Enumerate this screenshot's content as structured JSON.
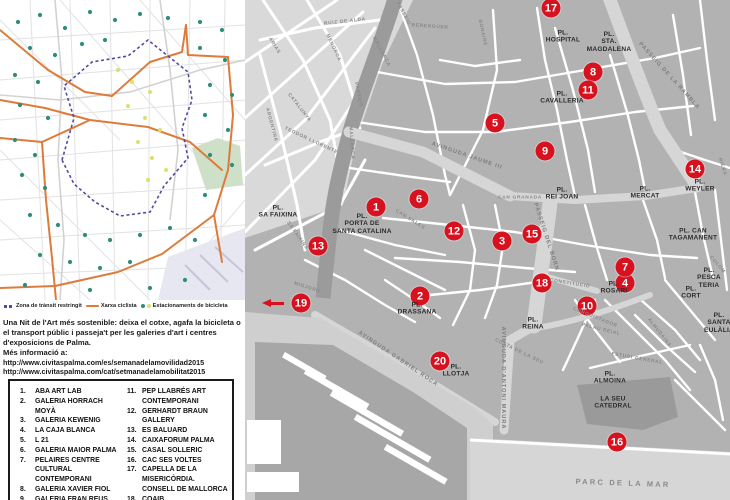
{
  "left_panel": {
    "legend": [
      {
        "label": "Zona de trànsit restringit",
        "color": "#4d4da0"
      },
      {
        "label": "Xarxa ciclista",
        "color": "#dd7b3a"
      },
      {
        "label": "Estacionaments de bicicleta",
        "colors": [
          "#2f8d7e",
          "#dde06a"
        ]
      }
    ],
    "intro": "Una Nit de l'Art més sostenible: deixa el cotxe, agafa la bicicleta o el transport públic i passeja't per les galeries d'art i centres d'exposicions de Palma.",
    "more_info_label": "Més informació a:",
    "links": [
      "http://www.civitaspalma.com/es/semanadelamovilidad2015",
      "http://www.civitaspalma.com/cat/setmanadelamobilitat2015"
    ],
    "gallery_list": {
      "left": [
        {
          "num": "1.",
          "name": "ABA ART LAB"
        },
        {
          "num": "2.",
          "name": "GALERIA HORRACH MOYÀ"
        },
        {
          "num": "3.",
          "name": "GALERIA KEWENIG"
        },
        {
          "num": "4.",
          "name": "LA CAJA BLANCA"
        },
        {
          "num": "5.",
          "name": "L 21"
        },
        {
          "num": "6.",
          "name": "GALERIA MAIOR PALMA"
        },
        {
          "num": "7.",
          "name": "PELAIRES CENTRE CULTURAL CONTEMPORANI"
        },
        {
          "num": "8.",
          "name": "GALERIA XAVIER FIOL"
        },
        {
          "num": "9.",
          "name": "GALERIA FRAN REUS"
        },
        {
          "num": "10.",
          "name": "GABRIEL VANRELL-GALERIA"
        }
      ],
      "right": [
        {
          "num": "11.",
          "name": "PEP LLABRÉS ART CONTEMPORANI"
        },
        {
          "num": "12.",
          "name": "GERHARDT BRAUN GALLERY"
        },
        {
          "num": "13.",
          "name": "ES BALUARD"
        },
        {
          "num": "14.",
          "name": "CAIXAFORUM PALMA"
        },
        {
          "num": "15.",
          "name": "CASAL SOLLERIC"
        },
        {
          "num": "16.",
          "name": "CAC SES VOLTES"
        },
        {
          "num": "17.",
          "name": "CAPELLA DE LA MISERICÒRDIA. CONSELL DE MALLORCA"
        },
        {
          "num": "18.",
          "name": "COAIB"
        },
        {
          "num": "19.",
          "name": "FUNDACIÓ PILAR I JOAN MIRÓ A MALLORCA"
        }
      ]
    }
  },
  "map": {
    "marker_color": "#d8111f",
    "markers": [
      {
        "num": "1",
        "x": 131,
        "y": 207
      },
      {
        "num": "2",
        "x": 175,
        "y": 296
      },
      {
        "num": "3",
        "x": 257,
        "y": 241
      },
      {
        "num": "4",
        "x": 380,
        "y": 283
      },
      {
        "num": "5",
        "x": 250,
        "y": 123
      },
      {
        "num": "6",
        "x": 174,
        "y": 199
      },
      {
        "num": "7",
        "x": 380,
        "y": 267
      },
      {
        "num": "8",
        "x": 348,
        "y": 72
      },
      {
        "num": "9",
        "x": 300,
        "y": 151
      },
      {
        "num": "10",
        "x": 342,
        "y": 306
      },
      {
        "num": "11",
        "x": 343,
        "y": 90
      },
      {
        "num": "12",
        "x": 209,
        "y": 231
      },
      {
        "num": "13",
        "x": 73,
        "y": 246
      },
      {
        "num": "14",
        "x": 450,
        "y": 169
      },
      {
        "num": "15",
        "x": 287,
        "y": 234
      },
      {
        "num": "16",
        "x": 372,
        "y": 442
      },
      {
        "num": "17",
        "x": 306,
        "y": 8
      },
      {
        "num": "18",
        "x": 297,
        "y": 283
      },
      {
        "num": "19",
        "x": 56,
        "y": 303
      },
      {
        "num": "20",
        "x": 195,
        "y": 361
      }
    ],
    "arrow": {
      "x": 28,
      "y": 303
    },
    "places": [
      {
        "label": "PL.\nHOSPITAL",
        "x": 318,
        "y": 37
      },
      {
        "label": "PL.\nSTA.\nMAGDALENA",
        "x": 364,
        "y": 42
      },
      {
        "label": "PL.\nCAVALLERIA",
        "x": 317,
        "y": 98
      },
      {
        "label": "PL.\nSA FAIXINA",
        "x": 33,
        "y": 212
      },
      {
        "label": "PL.\nPORTA DE\nSANTA CATALINA",
        "x": 117,
        "y": 224
      },
      {
        "label": "PL.\nREI JOAN",
        "x": 317,
        "y": 194
      },
      {
        "label": "PL.\nMERCAT",
        "x": 400,
        "y": 193
      },
      {
        "label": "PL.\nWEYLER",
        "x": 455,
        "y": 186
      },
      {
        "label": "PL. CAN\nTAGAMANENT",
        "x": 448,
        "y": 235
      },
      {
        "label": "PL.\nROSARI",
        "x": 369,
        "y": 288
      },
      {
        "label": "PL.\nPESCA\nTERIA",
        "x": 464,
        "y": 278
      },
      {
        "label": "PL.\nCORT",
        "x": 446,
        "y": 293
      },
      {
        "label": "PL.\nSANTA\nEULÀLIA",
        "x": 474,
        "y": 323
      },
      {
        "label": "PL.\nREINA",
        "x": 288,
        "y": 324
      },
      {
        "label": "PL.\nDRASSANA",
        "x": 172,
        "y": 309
      },
      {
        "label": "PL.\nLLOTJA",
        "x": 211,
        "y": 371
      },
      {
        "label": "PL.\nALMOINA",
        "x": 365,
        "y": 378
      },
      {
        "label": "LA SEU\nCATEDRAL",
        "x": 368,
        "y": 403
      }
    ],
    "streets": [
      {
        "t": "RUIZ  DE  ALDA",
        "x": 100,
        "y": 22,
        "r": -6
      },
      {
        "t": "ARIAS",
        "x": 29,
        "y": 46,
        "r": 58
      },
      {
        "t": "ARGENTINA",
        "x": 26,
        "y": 125,
        "r": 75
      },
      {
        "t": "CATALUNYA",
        "x": 54,
        "y": 108,
        "r": 52
      },
      {
        "t": "TEODOR LLORENTE",
        "x": 66,
        "y": 141,
        "r": 25
      },
      {
        "t": "MENORCA",
        "x": 88,
        "y": 48,
        "r": 65
      },
      {
        "t": "PASSEIG",
        "x": 158,
        "y": 14,
        "r": 62
      },
      {
        "t": "MALLORCA",
        "x": 136,
        "y": 52,
        "r": 62
      },
      {
        "t": "PASSEIG",
        "x": 113,
        "y": 95,
        "r": 78
      },
      {
        "t": "MALLORCA",
        "x": 106,
        "y": 143,
        "r": 86
      },
      {
        "t": "BERENGUER",
        "x": 185,
        "y": 27,
        "r": 4
      },
      {
        "t": "BONAIRE",
        "x": 237,
        "y": 33,
        "r": 78
      },
      {
        "t": "AVINGUDA  JAUME  III",
        "x": 222,
        "y": 156,
        "r": 19,
        "cls": "av"
      },
      {
        "t": "PASSEIG DE LA RAMBLA",
        "x": 424,
        "y": 76,
        "r": 48,
        "cls": "av"
      },
      {
        "t": "RIERA",
        "x": 477,
        "y": 167,
        "r": 72
      },
      {
        "t": "CAN  GRANADA",
        "x": 275,
        "y": 198,
        "r": 0
      },
      {
        "t": "CAN SALES",
        "x": 165,
        "y": 220,
        "r": 32
      },
      {
        "t": "SA FAIXINA",
        "x": 52,
        "y": 236,
        "r": 55
      },
      {
        "t": "PASSEIG DEL BORN",
        "x": 301,
        "y": 237,
        "r": 72,
        "cls": "av"
      },
      {
        "t": "CONSTITUCIÓ",
        "x": 325,
        "y": 284,
        "r": 9
      },
      {
        "t": "CONQUISTADOR",
        "x": 350,
        "y": 318,
        "r": 22
      },
      {
        "t": "MIGJORN",
        "x": 62,
        "y": 288,
        "r": 18
      },
      {
        "t": "COSTA DE LA SEU",
        "x": 274,
        "y": 352,
        "r": 26
      },
      {
        "t": "AVINGUDA GABRIEL ROCA",
        "x": 153,
        "y": 359,
        "r": 34,
        "cls": "av"
      },
      {
        "t": "AVINGUDA D'ANTONI MAURA",
        "x": 258,
        "y": 378,
        "r": 90,
        "cls": "av"
      },
      {
        "t": "ESTUDI  GENERAL",
        "x": 392,
        "y": 359,
        "r": 10
      },
      {
        "t": "PALAU  REIAL",
        "x": 356,
        "y": 330,
        "r": 14
      },
      {
        "t": "COLOM",
        "x": 472,
        "y": 265,
        "r": 50
      },
      {
        "t": "ALMUDAINA",
        "x": 414,
        "y": 333,
        "r": 52
      },
      {
        "t": "PARC  DE  LA  MAR",
        "x": 378,
        "y": 483,
        "r": 2,
        "cls": "parc"
      }
    ]
  }
}
